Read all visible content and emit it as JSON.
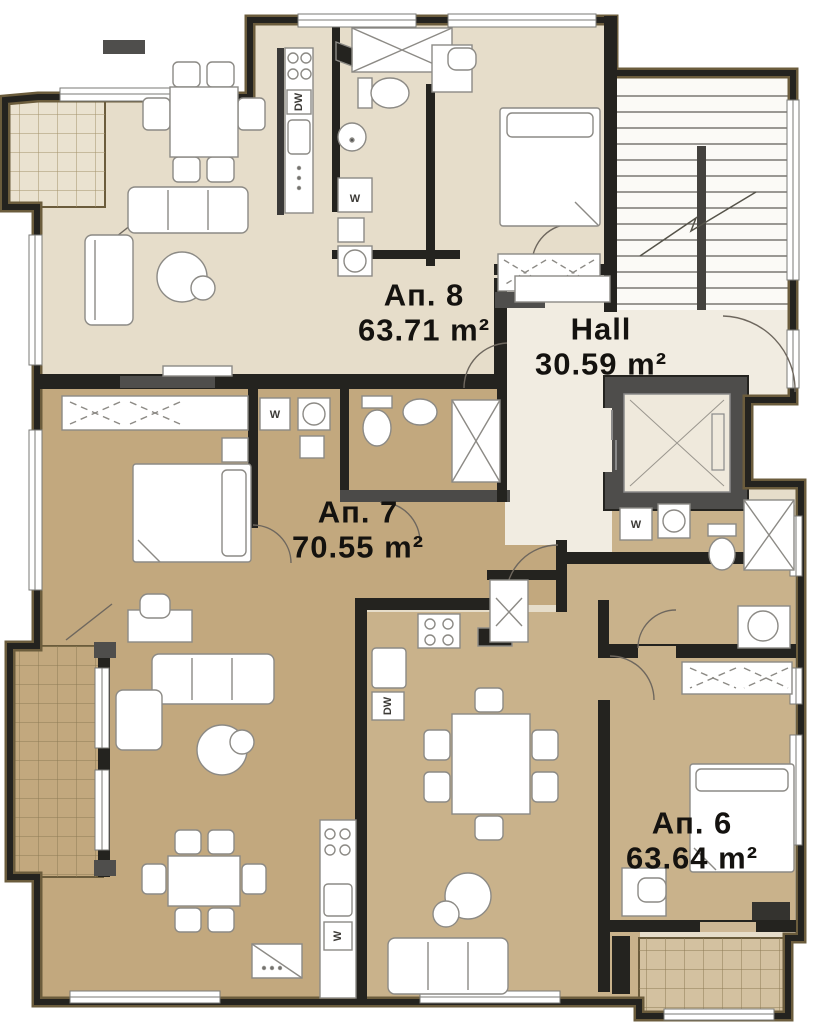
{
  "plan_type": "apartment-building-floor-plan",
  "units": [
    {
      "id": "apt8",
      "name": "Ап. 8",
      "area": "63.71 m²"
    },
    {
      "id": "hall",
      "name": "Hall",
      "area": "30.59 m²"
    },
    {
      "id": "apt7",
      "name": "Ап. 7",
      "area": "70.55 m²"
    },
    {
      "id": "apt6",
      "name": "Ап. 6",
      "area": "63.64 m²"
    }
  ],
  "fixtures": {
    "washer": "W",
    "dishwasher": "DW"
  },
  "colors": {
    "apt8_fill": "#e6ddca",
    "apt7_fill": "#c2a87e",
    "apt6_fill": "#c9b28b",
    "hall_fill": "#f1ece1",
    "stairwell_fill": "#fbfaf6",
    "wall_dark": "#24231f",
    "wall_gray": "#4f4e4c",
    "outline_brown": "#6b5c3c",
    "furniture_stroke": "#8c8a85"
  }
}
